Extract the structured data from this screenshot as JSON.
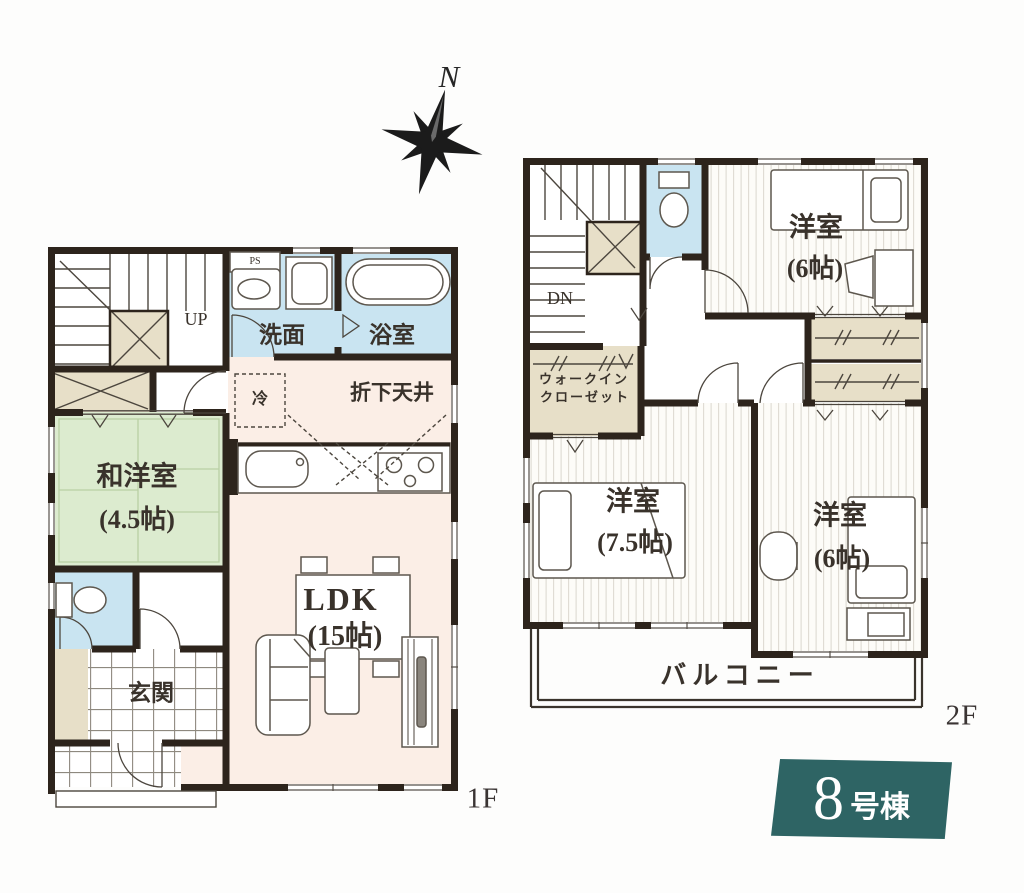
{
  "compass": {
    "north": "N"
  },
  "f1": {
    "floor": "1F",
    "ps": "PS",
    "up": "UP",
    "senmen": "洗面",
    "yokushitsu": "浴室",
    "rei": "冷",
    "orishitenjo": "折下天井",
    "wayoshitsu": "和洋室",
    "wayoshitsu_size": "(4.5帖)",
    "ldk": "LDK",
    "ldk_size": "(15帖)",
    "genkan": "玄関"
  },
  "f2": {
    "floor": "2F",
    "dn": "DN",
    "yoshitsu_top": "洋室",
    "yoshitsu_top_size": "(6帖)",
    "wic_line1": "ウォークイン",
    "wic_line2": "クローゼット",
    "yoshitsu_left": "洋室",
    "yoshitsu_left_size": "(7.5帖)",
    "yoshitsu_right": "洋室",
    "yoshitsu_right_size": "(6帖)",
    "balcony": "バルコニー"
  },
  "banner": {
    "number": "8",
    "suffix": "号棟"
  },
  "colors": {
    "wall": "#2d241c",
    "wet_room_blue": "#c9e4f1",
    "tatami_green": "#dcebcf",
    "ldk_cream": "#fbeee6",
    "closet_beige": "#e7dfc8",
    "banner_teal": "#2e6464",
    "label_ink": "#39322b"
  }
}
